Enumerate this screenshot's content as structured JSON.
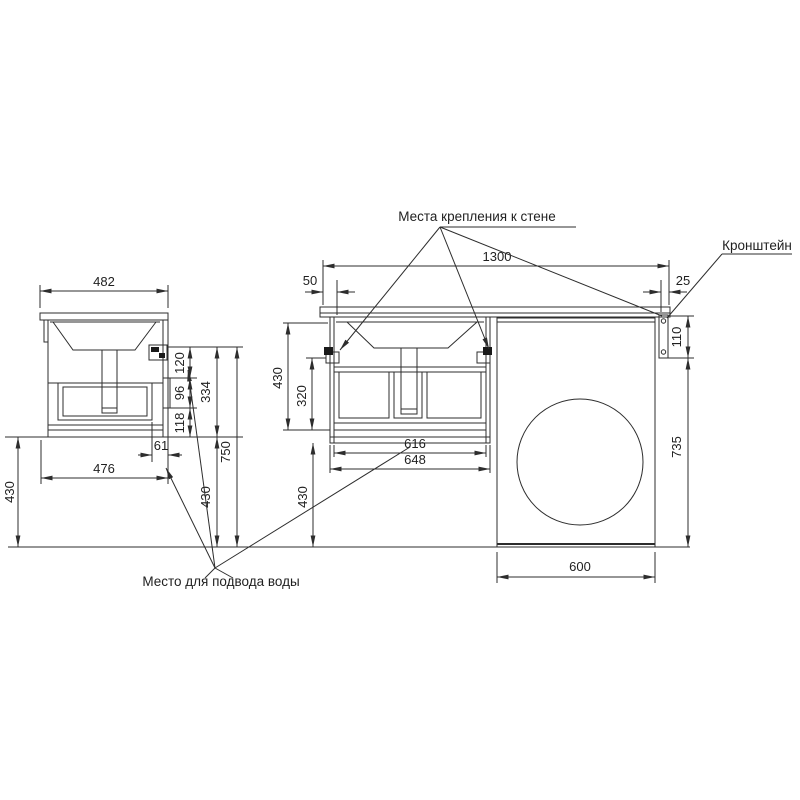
{
  "labels": {
    "wall_mount": "Места крепления к стене",
    "bracket": "Кронштейн",
    "water_supply": "Место для подвода воды"
  },
  "side_view": {
    "top_width": "482",
    "bottom_width": "476",
    "back_offset": "61",
    "left_floor_height": "430",
    "seg_top": "120",
    "seg_mid": "96",
    "seg_bottom": "118",
    "seg_total": "334",
    "bracket_to_floor": "750",
    "under_height": "430"
  },
  "front_view": {
    "total_width": "1300",
    "left_gap": "50",
    "right_gap": "25",
    "cabinet_height": "430",
    "inner_height": "320",
    "under_height": "430",
    "inner_width": "616",
    "cabinet_width": "648",
    "bracket_height": "110",
    "bracket_to_floor": "735",
    "washer_width": "600"
  },
  "colors": {
    "line": "#2d2d2d",
    "background": "#ffffff"
  }
}
